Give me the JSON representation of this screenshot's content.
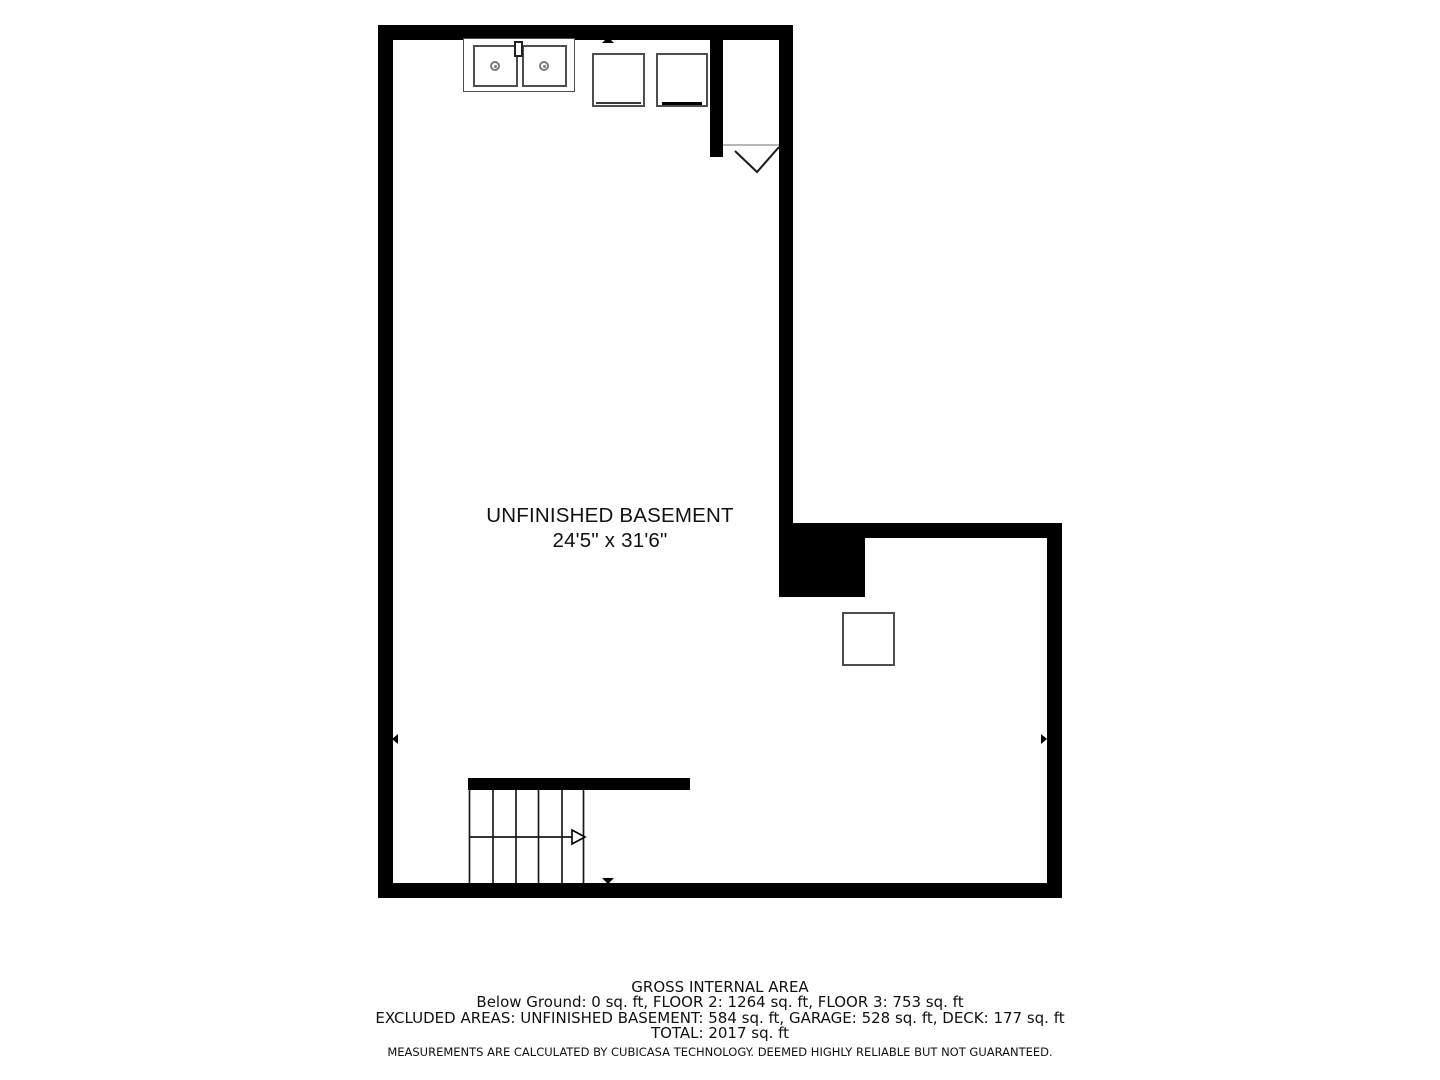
{
  "room": {
    "label": "UNFINISHED BASEMENT",
    "dimensions": "24'5\" x 31'6\""
  },
  "footer": {
    "title": "GROSS INTERNAL AREA",
    "floors_line": "Below Ground: 0 sq. ft, FLOOR 2: 1264 sq. ft, FLOOR 3: 753 sq. ft",
    "excluded_line": "EXCLUDED AREAS: UNFINISHED BASEMENT: 584 sq. ft, GARAGE: 528 sq. ft, DECK: 177 sq. ft",
    "total_line": "TOTAL: 2017 sq. ft",
    "disclaimer": "MEASUREMENTS ARE CALCULATED BY CUBICASA TECHNOLOGY. DEEMED HIGHLY RELIABLE BUT NOT GUARANTEED."
  },
  "symbols": {
    "sink": "double-basin-sink-icon",
    "appliance_top_1": "appliance-square-icon",
    "appliance_top_2": "appliance-square-icon",
    "appliance_lower": "appliance-square-icon",
    "stairs": "staircase-with-up-arrow-icon",
    "door": "door-swing-icon",
    "chimney": "solid-masonry-block"
  },
  "colors": {
    "wall": "#000000",
    "fixture_outline": "#4d4d4d",
    "background": "#ffffff",
    "text": "#111111"
  }
}
